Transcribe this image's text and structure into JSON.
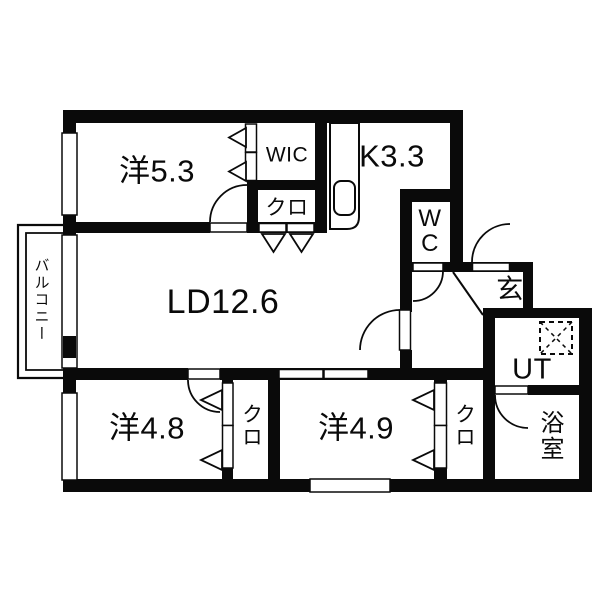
{
  "colors": {
    "background": "#ffffff",
    "wall": "#0a0a0a",
    "line": "#0a0a0a"
  },
  "rooms": {
    "bedroom_5_3": {
      "label": "洋5.3"
    },
    "wic": {
      "label": "WIC"
    },
    "kitchen": {
      "label": "K3.3"
    },
    "closet_wic_side": {
      "label": "クロ"
    },
    "living_dining": {
      "label": "LD12.6"
    },
    "toilet": {
      "label": "WC"
    },
    "entrance": {
      "label": "玄"
    },
    "balcony": {
      "label": "バルコニー"
    },
    "utility": {
      "label": "UT"
    },
    "bathroom": {
      "label": "浴室"
    },
    "bedroom_4_8": {
      "label": "洋4.8"
    },
    "closet_4_8": {
      "label": "クロ"
    },
    "bedroom_4_9": {
      "label": "洋4.9"
    },
    "closet_4_9": {
      "label": "クロ"
    }
  },
  "fixtures": {
    "kitchen_sink": "sink-icon",
    "washer_pan": "washing-machine-pan-icon"
  }
}
